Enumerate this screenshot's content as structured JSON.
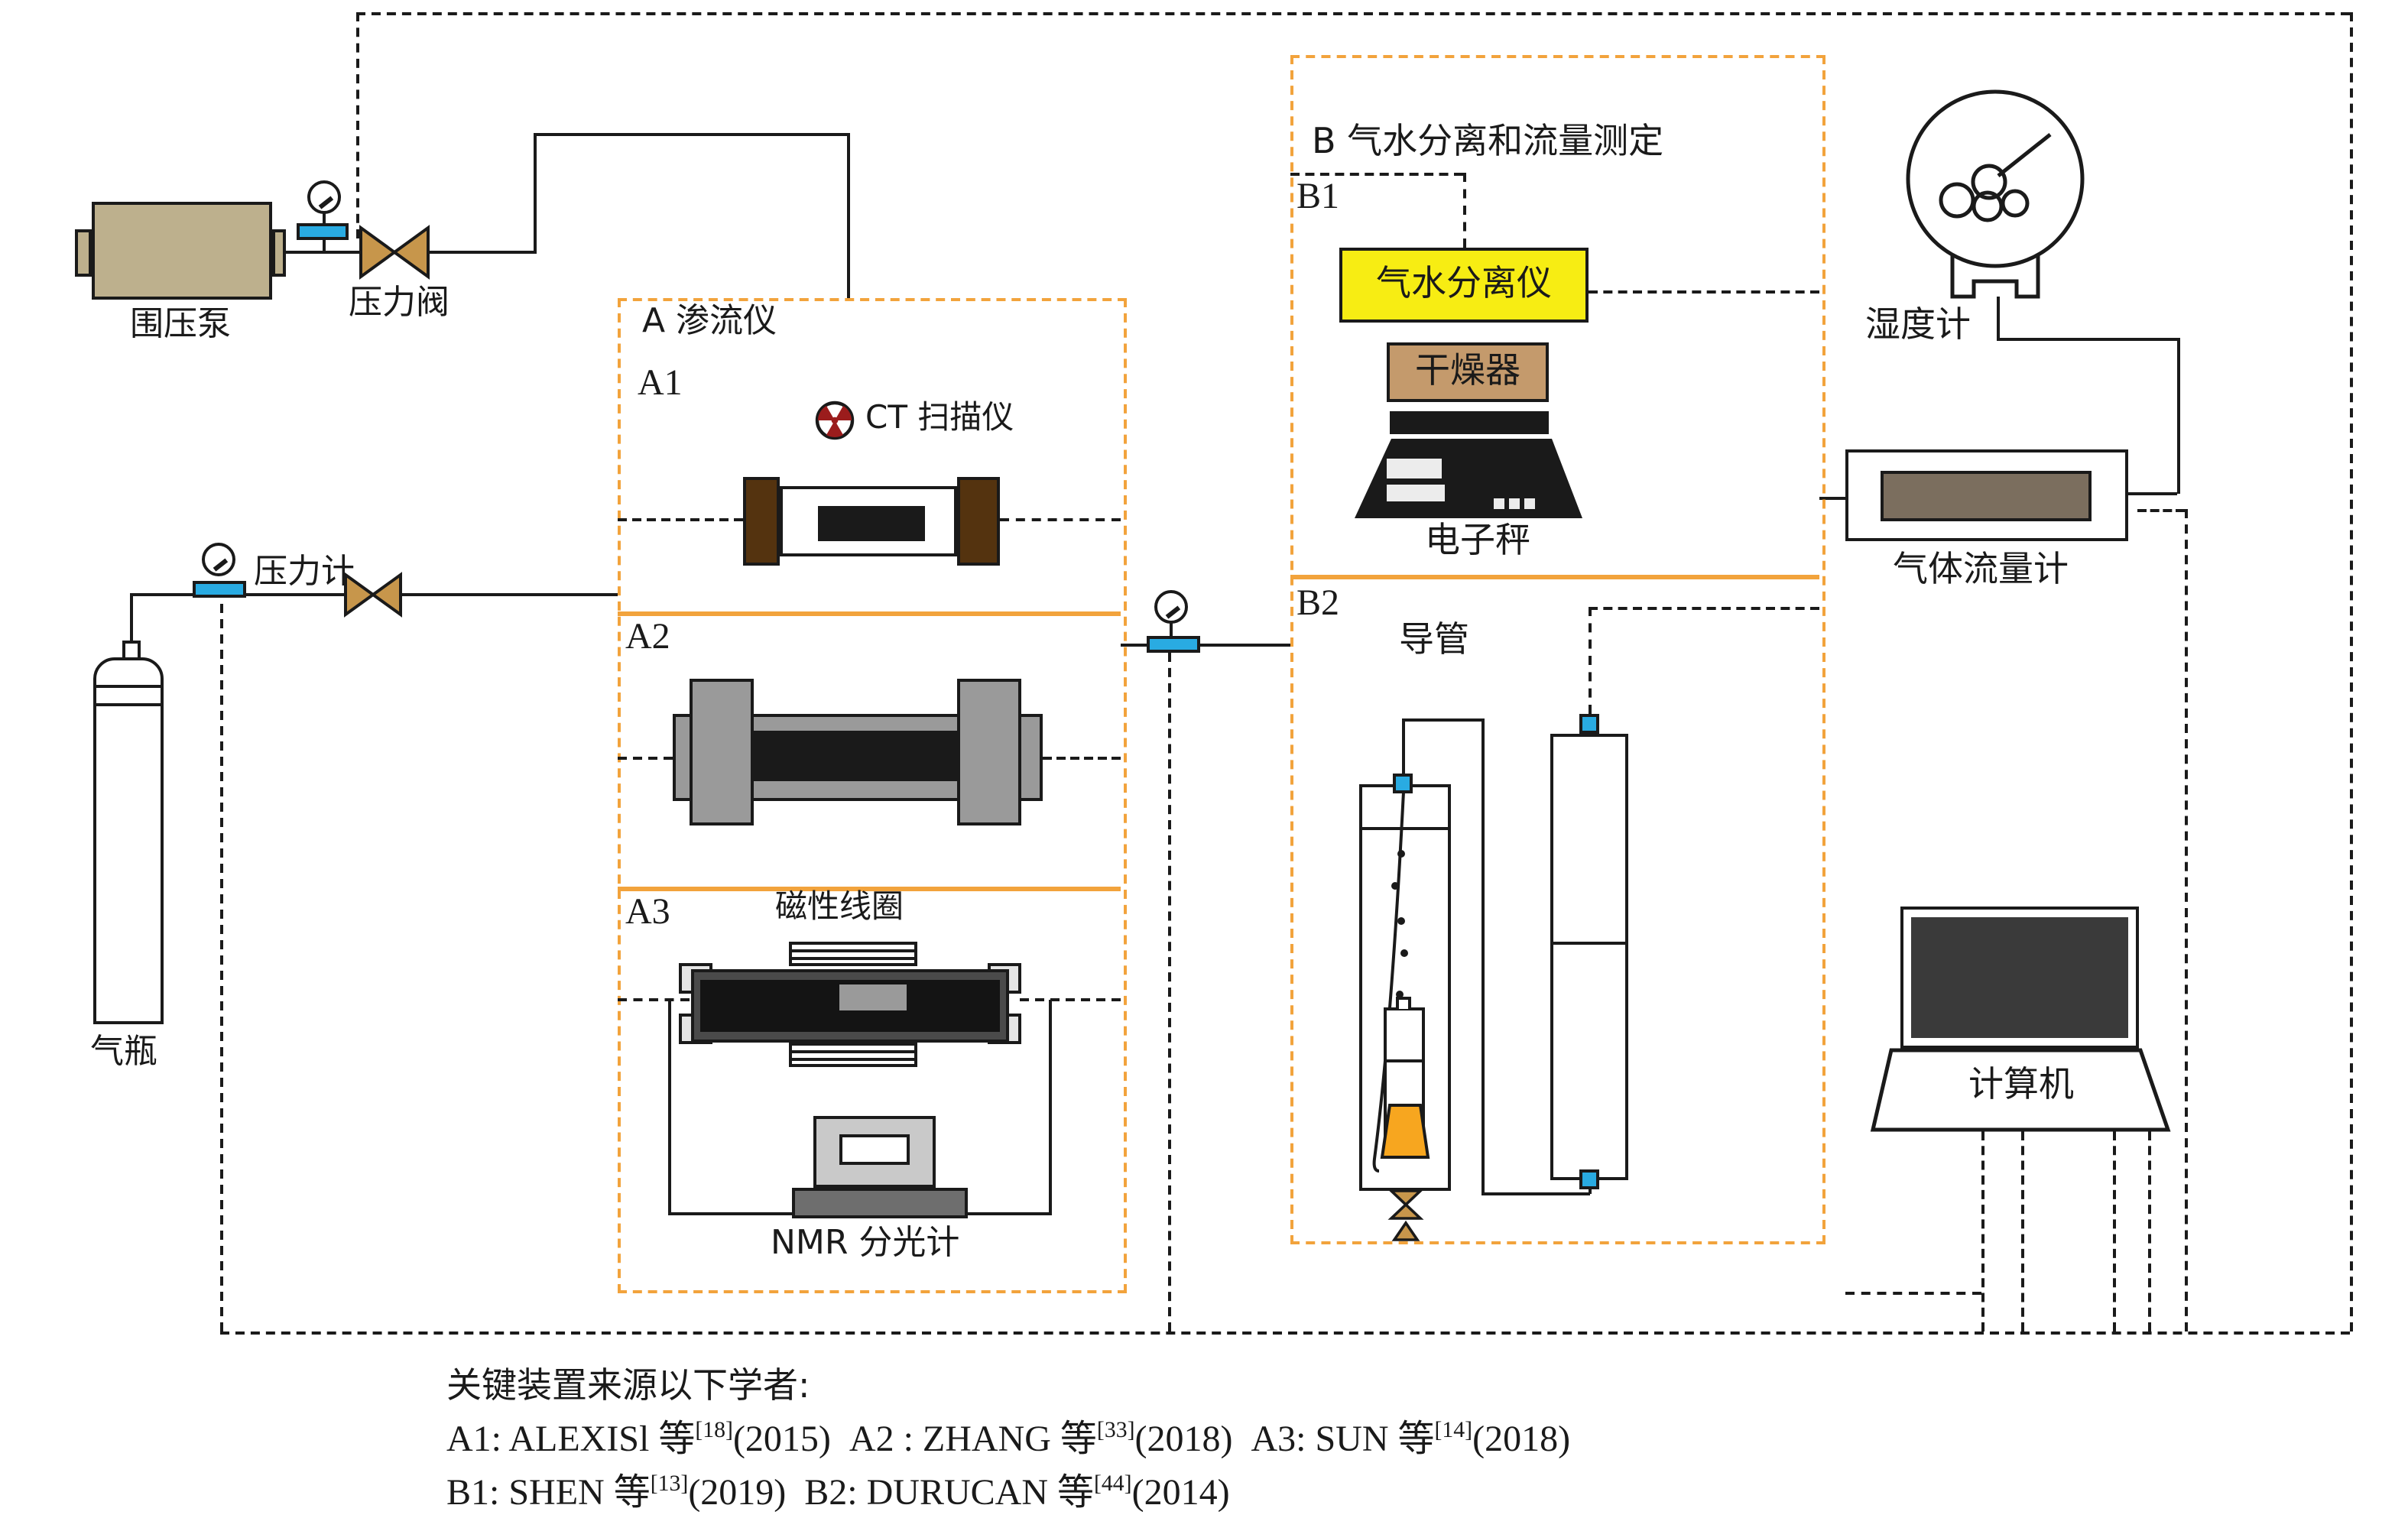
{
  "labels": {
    "pump": "围压泵",
    "pressure_valve": "压力阀",
    "pressure_gauge": "压力计",
    "cylinder": "气瓶",
    "box_a": "A 渗流仪",
    "a1": "A1",
    "a2": "A2",
    "a3": "A3",
    "ct": "CT 扫描仪",
    "coil": "磁性线圈",
    "nmr": "NMR 分光计",
    "box_b": "B 气水分离和流量测定",
    "b1": "B1",
    "b2": "B2",
    "separator": "气水分离仪",
    "dryer": "干燥器",
    "scale": "电子秤",
    "duct": "导管",
    "hygrometer": "湿度计",
    "flowmeter": "气体流量计",
    "computer": "计算机"
  },
  "credits": {
    "title": "关键装置来源以下学者:",
    "lines": [
      [
        {
          "t": "A1: ALEXISl 等"
        },
        {
          "t": "[18]",
          "sup": true
        },
        {
          "t": "(2015)  A2 : ZHANG 等"
        },
        {
          "t": "[33]",
          "sup": true
        },
        {
          "t": "(2018)  A3: SUN 等"
        },
        {
          "t": "[14]",
          "sup": true
        },
        {
          "t": "(2018)"
        }
      ],
      [
        {
          "t": "B1: SHEN 等"
        },
        {
          "t": "[13]",
          "sup": true
        },
        {
          "t": "(2019)  B2: DURUCAN 等"
        },
        {
          "t": "[44]",
          "sup": true
        },
        {
          "t": "(2014)"
        }
      ]
    ]
  },
  "colors": {
    "accent_orange": "#F2A33C",
    "funnel_orange": "#F7A61F",
    "blue": "#29ABE2",
    "yellow": "#F7ED13",
    "valve_tan": "#C7964B",
    "pump_khaki": "#BDB08D",
    "dryer_brown": "#C49A6C",
    "holder_brown": "#54330F",
    "radiation_red": "#9B1C1C",
    "meter_brown": "#7B6E5E"
  }
}
